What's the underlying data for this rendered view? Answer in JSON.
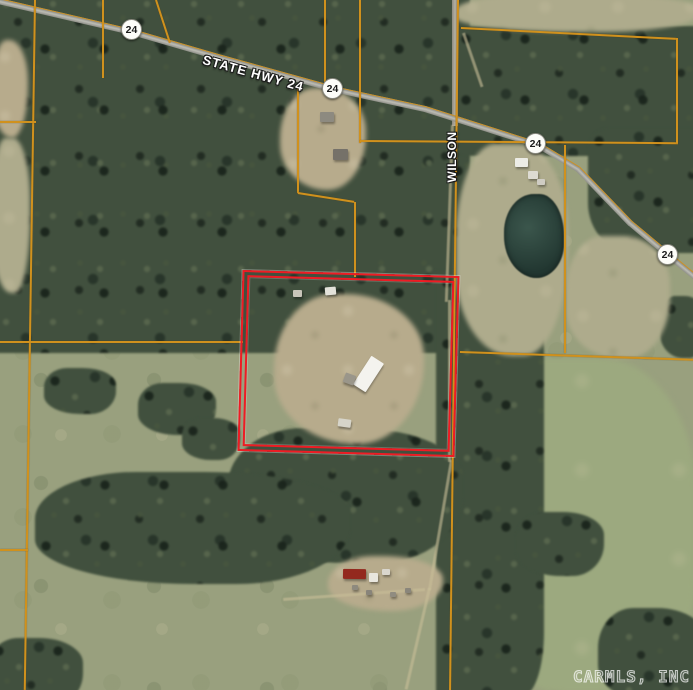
{
  "map": {
    "highway_label": "STATE HWY 24",
    "street_label": "WILSON",
    "watermark": "CARMLS, INC",
    "shields": [
      {
        "route": "24"
      },
      {
        "route": "24"
      },
      {
        "route": "24"
      },
      {
        "route": "24"
      }
    ],
    "colors": {
      "parcel_boundary": "#d0911d",
      "subject_outline": "#ee1c24",
      "road": "#b0b0a8",
      "forest": "#41503e",
      "field": "#99a07e",
      "pond": "#2c453d"
    }
  }
}
